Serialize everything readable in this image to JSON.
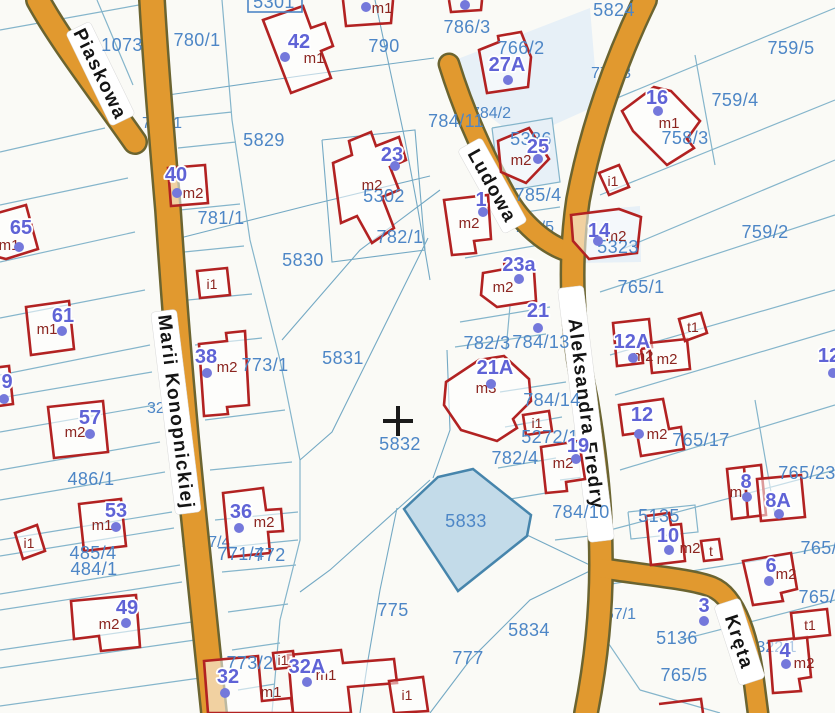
{
  "map": {
    "streets": [
      {
        "name": "Piaskowa"
      },
      {
        "name": "Marii Konopnickiej"
      },
      {
        "name": "Ludowa"
      },
      {
        "name": "Aleksandra Fredry"
      },
      {
        "name": "Kręta"
      }
    ],
    "highlighted_parcel": {
      "number": "5833"
    },
    "parcels": [
      {
        "number": "5301"
      },
      {
        "number": "1073"
      },
      {
        "number": "780/1"
      },
      {
        "number": "790"
      },
      {
        "number": "786/3"
      },
      {
        "number": "766/2"
      },
      {
        "number": "5824"
      },
      {
        "number": "759/5"
      },
      {
        "number": "759/4"
      },
      {
        "number": "758/3"
      },
      {
        "number": "5829"
      },
      {
        "number": "5302"
      },
      {
        "number": "782/1"
      },
      {
        "number": "784/11"
      },
      {
        "number": "5386"
      },
      {
        "number": "785/4"
      },
      {
        "number": "781/1"
      },
      {
        "number": "5830"
      },
      {
        "number": "759/2"
      },
      {
        "number": "765/1"
      },
      {
        "number": "5323"
      },
      {
        "number": "773/1"
      },
      {
        "number": "5831"
      },
      {
        "number": "784/13"
      },
      {
        "number": "782/3"
      },
      {
        "number": "784/14"
      },
      {
        "number": "5272/1"
      },
      {
        "number": "782/4"
      },
      {
        "number": "5832"
      },
      {
        "number": "486/1"
      },
      {
        "number": "485/4"
      },
      {
        "number": "484/1"
      },
      {
        "number": "771/4"
      },
      {
        "number": "772"
      },
      {
        "number": "784/10"
      },
      {
        "number": "5135"
      },
      {
        "number": "765/17"
      },
      {
        "number": "765/23"
      },
      {
        "number": "765/2"
      },
      {
        "number": "765/1"
      },
      {
        "number": "775"
      },
      {
        "number": "5834"
      },
      {
        "number": "777"
      },
      {
        "number": "5136"
      },
      {
        "number": "765/5"
      },
      {
        "number": "773/2"
      }
    ],
    "hidden_parcels": [
      {
        "number": "719/1"
      },
      {
        "number": "777/3"
      },
      {
        "number": "784/2"
      },
      {
        "number": "785/5"
      },
      {
        "number": "324/5"
      },
      {
        "number": "1857/4"
      },
      {
        "number": "757/1"
      },
      {
        "number": "5322/1"
      }
    ],
    "addresses": [
      {
        "number": "42",
        "building": "m1"
      },
      {
        "number": "40",
        "building": "m2"
      },
      {
        "number": "65",
        "building": "m1"
      },
      {
        "number": "61",
        "building": "m1"
      },
      {
        "number": "9"
      },
      {
        "number": "57",
        "building": "m2"
      },
      {
        "number": "53",
        "building": "m1"
      },
      {
        "number": "49",
        "building": "m2"
      },
      {
        "number": "38",
        "building": "m2"
      },
      {
        "number": "36",
        "building": "m2"
      },
      {
        "number": "32",
        "building": "m1"
      },
      {
        "number": "32A",
        "building": "m1"
      },
      {
        "number": "23",
        "building": "m2"
      },
      {
        "number": "1",
        "building": "m2"
      },
      {
        "number": "27A"
      },
      {
        "number": "25",
        "building": "m2"
      },
      {
        "number": "23a",
        "building": "m2"
      },
      {
        "number": "21"
      },
      {
        "number": "21A",
        "building": "m3"
      },
      {
        "number": "16",
        "building": "m1"
      },
      {
        "number": "14",
        "building": "m2"
      },
      {
        "number": "12A",
        "building": "m2",
        "building2": "m2"
      },
      {
        "number": "12",
        "building": "m2"
      },
      {
        "number": "19",
        "building": "m2"
      },
      {
        "number": "8",
        "building": "m1"
      },
      {
        "number": "8A"
      },
      {
        "number": "6",
        "building": "m2"
      },
      {
        "number": "10",
        "building": "m2"
      },
      {
        "number": "4",
        "building": "m2"
      },
      {
        "number": "3"
      },
      {
        "number": "12"
      },
      {
        "number": "",
        "building": "m1"
      }
    ],
    "outbuildings": [
      {
        "label": "i1"
      },
      {
        "label": "i1"
      },
      {
        "label": "t1"
      },
      {
        "label": "i1"
      },
      {
        "label": "t1"
      },
      {
        "label": "t"
      },
      {
        "label": "i1"
      },
      {
        "label": "i1"
      },
      {
        "label": "i1"
      }
    ],
    "colors": {
      "road_fill": "#E1992F",
      "road_casing": "#6B6430",
      "parcel_line": "#85B5CB",
      "building_outline": "#B22222",
      "address_text": "#5F63D6",
      "parcel_text": "#4D86C6",
      "building_label_text": "#8B2520",
      "highlight_fill": "#C3DBE9",
      "highlight_stroke": "#4685AC"
    }
  }
}
